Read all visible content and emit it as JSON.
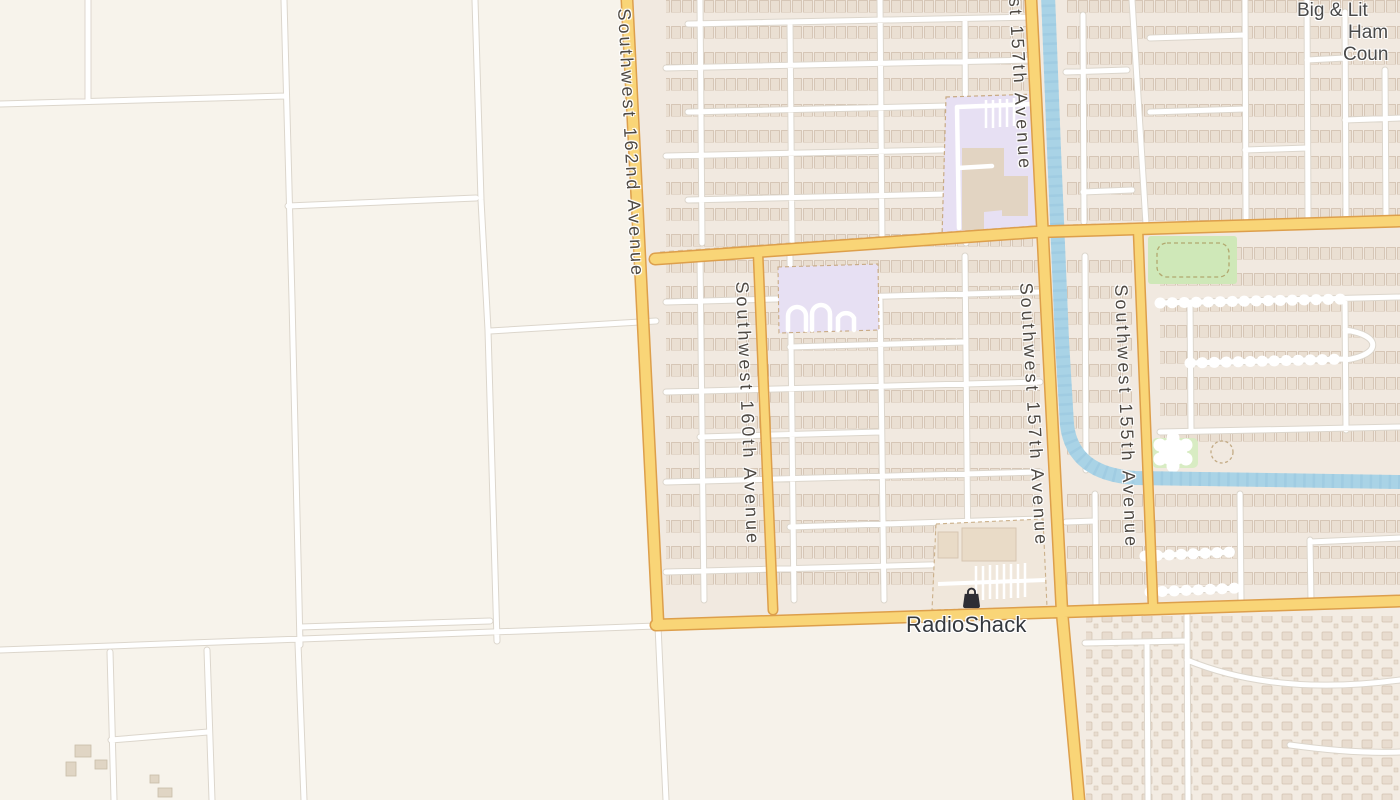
{
  "map": {
    "street_labels": {
      "s162": "Southwest 162nd Avenue",
      "s157_top_fragment": "st 157th Avenue",
      "s157": "Southwest 157th Avenue",
      "s160": "Southwest 160th Avenue",
      "s155": "Southwest 155th Avenue"
    },
    "poi": {
      "radioshack": "RadioShack",
      "radioshack_icon": "shopping-bag-icon"
    },
    "corner_text_fragments": {
      "line1": "Big & Lit",
      "line2": "Ham",
      "line3": "Coun"
    },
    "colors": {
      "rural_bg": "#f7f3eb",
      "urban_block": "#f1e9e0",
      "major_road_fill": "#f9d577",
      "major_road_casing": "#dd9f4b",
      "minor_road_fill": "#ffffff",
      "minor_road_casing": "#dcd6cc",
      "water": "#a9d3e6",
      "park_green": "#cfe8b8",
      "campus_lavender": "#e7e0f3",
      "building_tan": "#e2d4c2",
      "label_text": "#4e4943",
      "poi_text": "#34383d",
      "poi_icon_dark": "#2e2e34"
    }
  }
}
